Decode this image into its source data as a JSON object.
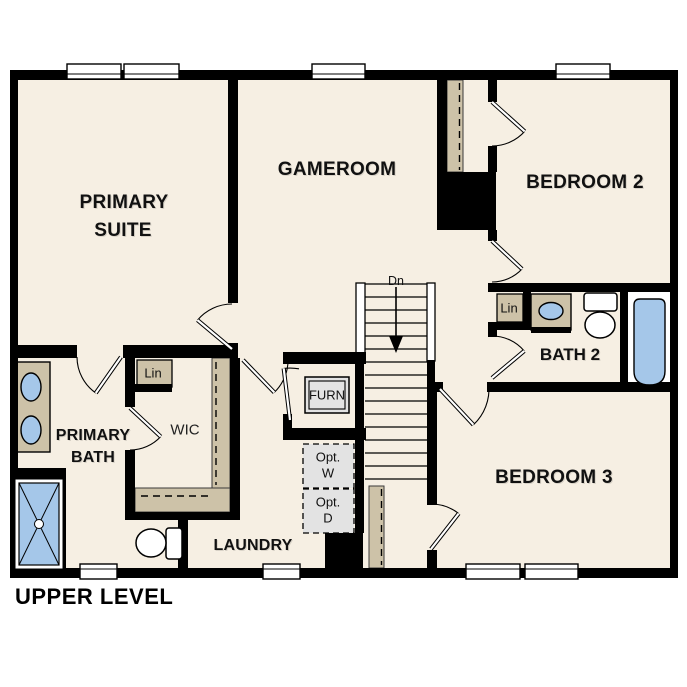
{
  "plan": {
    "title": "UPPER LEVEL",
    "rooms": {
      "primary_suite": {
        "line1": "PRIMARY",
        "line2": "SUITE"
      },
      "gameroom": {
        "label": "GAMEROOM"
      },
      "bedroom2": {
        "label": "BEDROOM 2"
      },
      "bath2": {
        "label": "BATH 2"
      },
      "bedroom3": {
        "label": "BEDROOM 3"
      },
      "primary_bath": {
        "line1": "PRIMARY",
        "line2": "BATH"
      },
      "wic": {
        "label": "WIC"
      },
      "laundry": {
        "label": "LAUNDRY"
      }
    },
    "features": {
      "linen_wic": "Lin",
      "linen_bath2": "Lin",
      "furnace": "FURN",
      "opt_washer": {
        "line1": "Opt.",
        "line2": "W"
      },
      "opt_dryer": {
        "line1": "Opt.",
        "line2": "D"
      },
      "stairs_direction": "Dn"
    },
    "colors": {
      "background": "#ffffff",
      "floor": "#f6efe3",
      "wall": "#000000",
      "casework_tan": "#cdc2a8",
      "fixture_blue": "#a5c7e9",
      "optional_gray": "#e3e3e3"
    }
  }
}
